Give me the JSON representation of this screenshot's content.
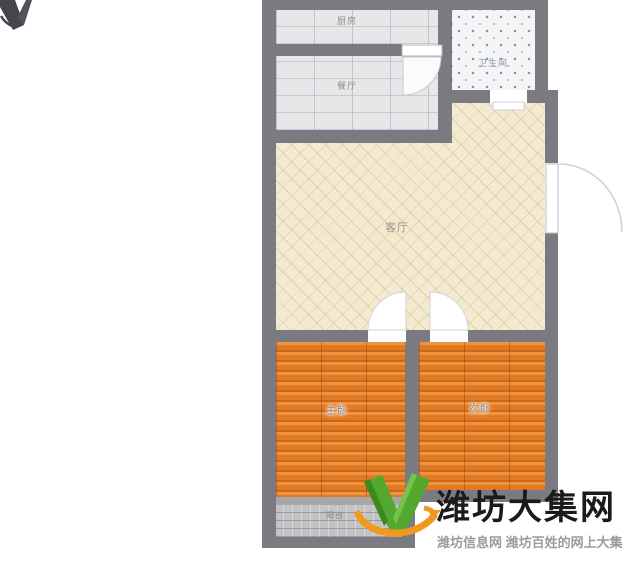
{
  "floorplan": {
    "rooms": {
      "kitchen": {
        "label": "厨房"
      },
      "dining": {
        "label": "餐厅"
      },
      "bathroom": {
        "label": "卫生间"
      },
      "living": {
        "label": "客厅"
      },
      "bedroom_left": {
        "label": "主卧"
      },
      "bedroom_right": {
        "label": "次卧"
      },
      "balcony": {
        "label": "阳台"
      }
    },
    "icons": {
      "compass_mark": "compass-north-mark"
    },
    "colors": {
      "wall": "#7a7a80",
      "living_floor": "#f3ead0",
      "kitchen_dining_floor": "#e7e7ea",
      "bathroom_floor": "#f4f5f7",
      "bedroom_wood_floor": "#e07a24",
      "balcony_floor": "#c3c3c6"
    }
  },
  "watermark": {
    "title": "潍坊大集网",
    "tagline": "潍坊信息网 潍坊百姓的网上大集",
    "logo_icon": "v-swoosh-logo",
    "title_color": "#1b1b1b",
    "tagline_color": "#9b9b9b",
    "logo_green": "#55a82f",
    "logo_orange": "#f0991e"
  }
}
